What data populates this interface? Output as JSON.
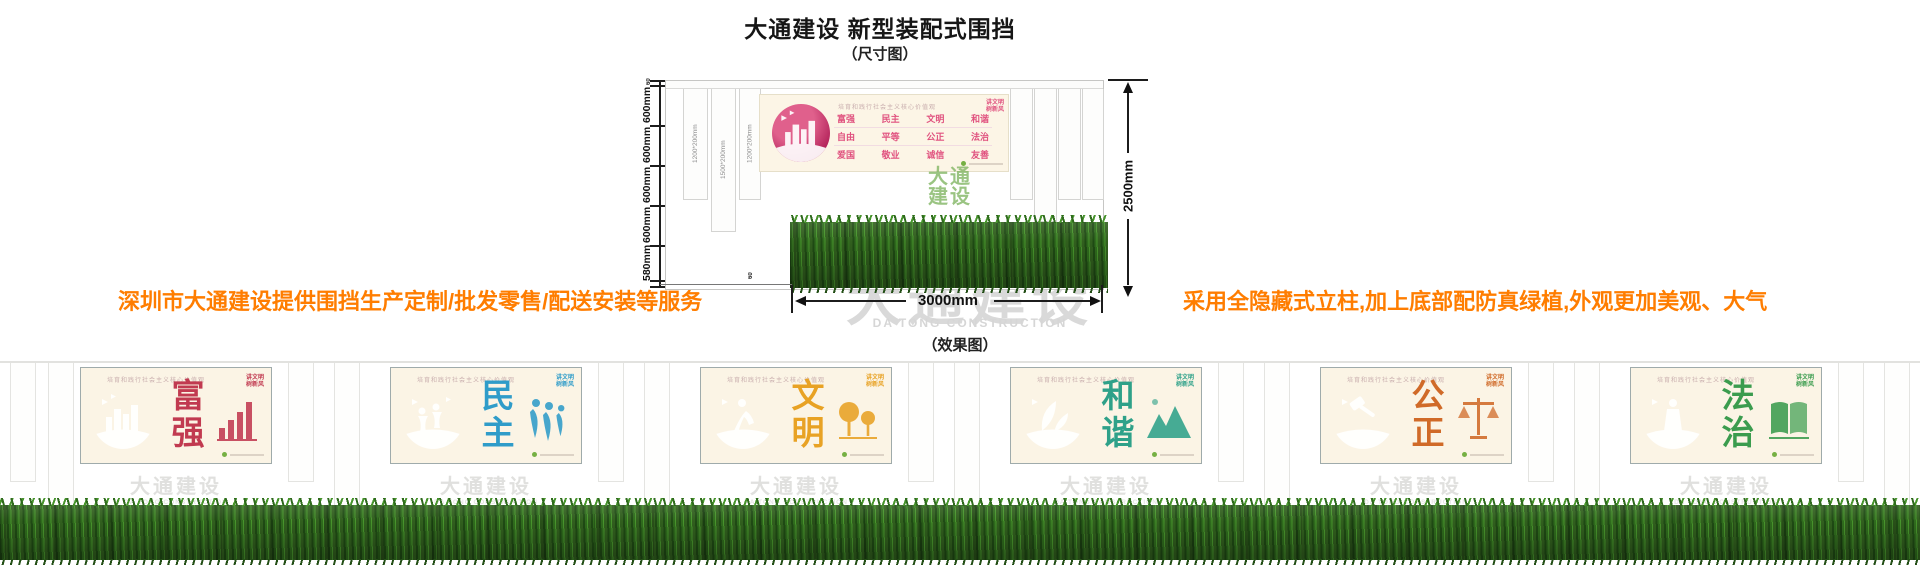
{
  "header": {
    "title": "大通建设 新型装配式围挡",
    "dim_caption": "（尺寸图）",
    "effect_caption": "（效果图）"
  },
  "notes": {
    "left": "深圳市大通建设提供围挡生产定制/批发零售/配送安装等服务",
    "right": "采用全隐藏式立柱,加上底部配防真绿植,外观更加美观、大气"
  },
  "diagram": {
    "ruler": {
      "top_small": "60",
      "segments": [
        "600mm",
        "600mm",
        "600mm",
        "600mm",
        "580mm"
      ],
      "bottom_small": "60"
    },
    "total_height": "2500mm",
    "unit_width": "3000mm",
    "post_labels": [
      "1200*200mm",
      "1500*200mm",
      "1200*200mm"
    ],
    "banner": {
      "slogan": "培育和践行社会主义核心价值观",
      "values": [
        "富强",
        "民主",
        "文明",
        "和谐",
        "自由",
        "平等",
        "公正",
        "法治",
        "爱国",
        "敬业",
        "诚信",
        "友善"
      ]
    },
    "green_mark_lines": [
      "大通",
      "建设"
    ]
  },
  "watermark": {
    "cn": "大通建设",
    "en": "DA TONG CONSTRUCTION"
  },
  "effect": {
    "badge_lines": [
      "讲文明",
      "树新风"
    ],
    "panels": [
      {
        "chars": [
          "富",
          "强"
        ],
        "color": "#c13a50",
        "circle_a": "#e0607e",
        "circle_b": "#9c1432"
      },
      {
        "chars": [
          "民",
          "主"
        ],
        "color": "#2f9cc9",
        "circle_a": "#5cc0e4",
        "circle_b": "#177ca8"
      },
      {
        "chars": [
          "文",
          "明"
        ],
        "color": "#e8a224",
        "circle_a": "#f4c04e",
        "circle_b": "#cf8a10"
      },
      {
        "chars": [
          "和",
          "谐"
        ],
        "color": "#2ea189",
        "circle_a": "#5cc3ad",
        "circle_b": "#157a66"
      },
      {
        "chars": [
          "公",
          "正"
        ],
        "color": "#d06a28",
        "circle_a": "#e89050",
        "circle_b": "#b24e12"
      },
      {
        "chars": [
          "法",
          "治"
        ],
        "color": "#3b9c4e",
        "circle_a": "#66bd74",
        "circle_b": "#247a36"
      }
    ]
  },
  "colors": {
    "accent_orange": "#ff7d00",
    "values_pink": "#e0527f",
    "watermark_gray": "#d9d9d9",
    "hedge_green": "#2f6b1d",
    "logo_green": "#76b043"
  }
}
